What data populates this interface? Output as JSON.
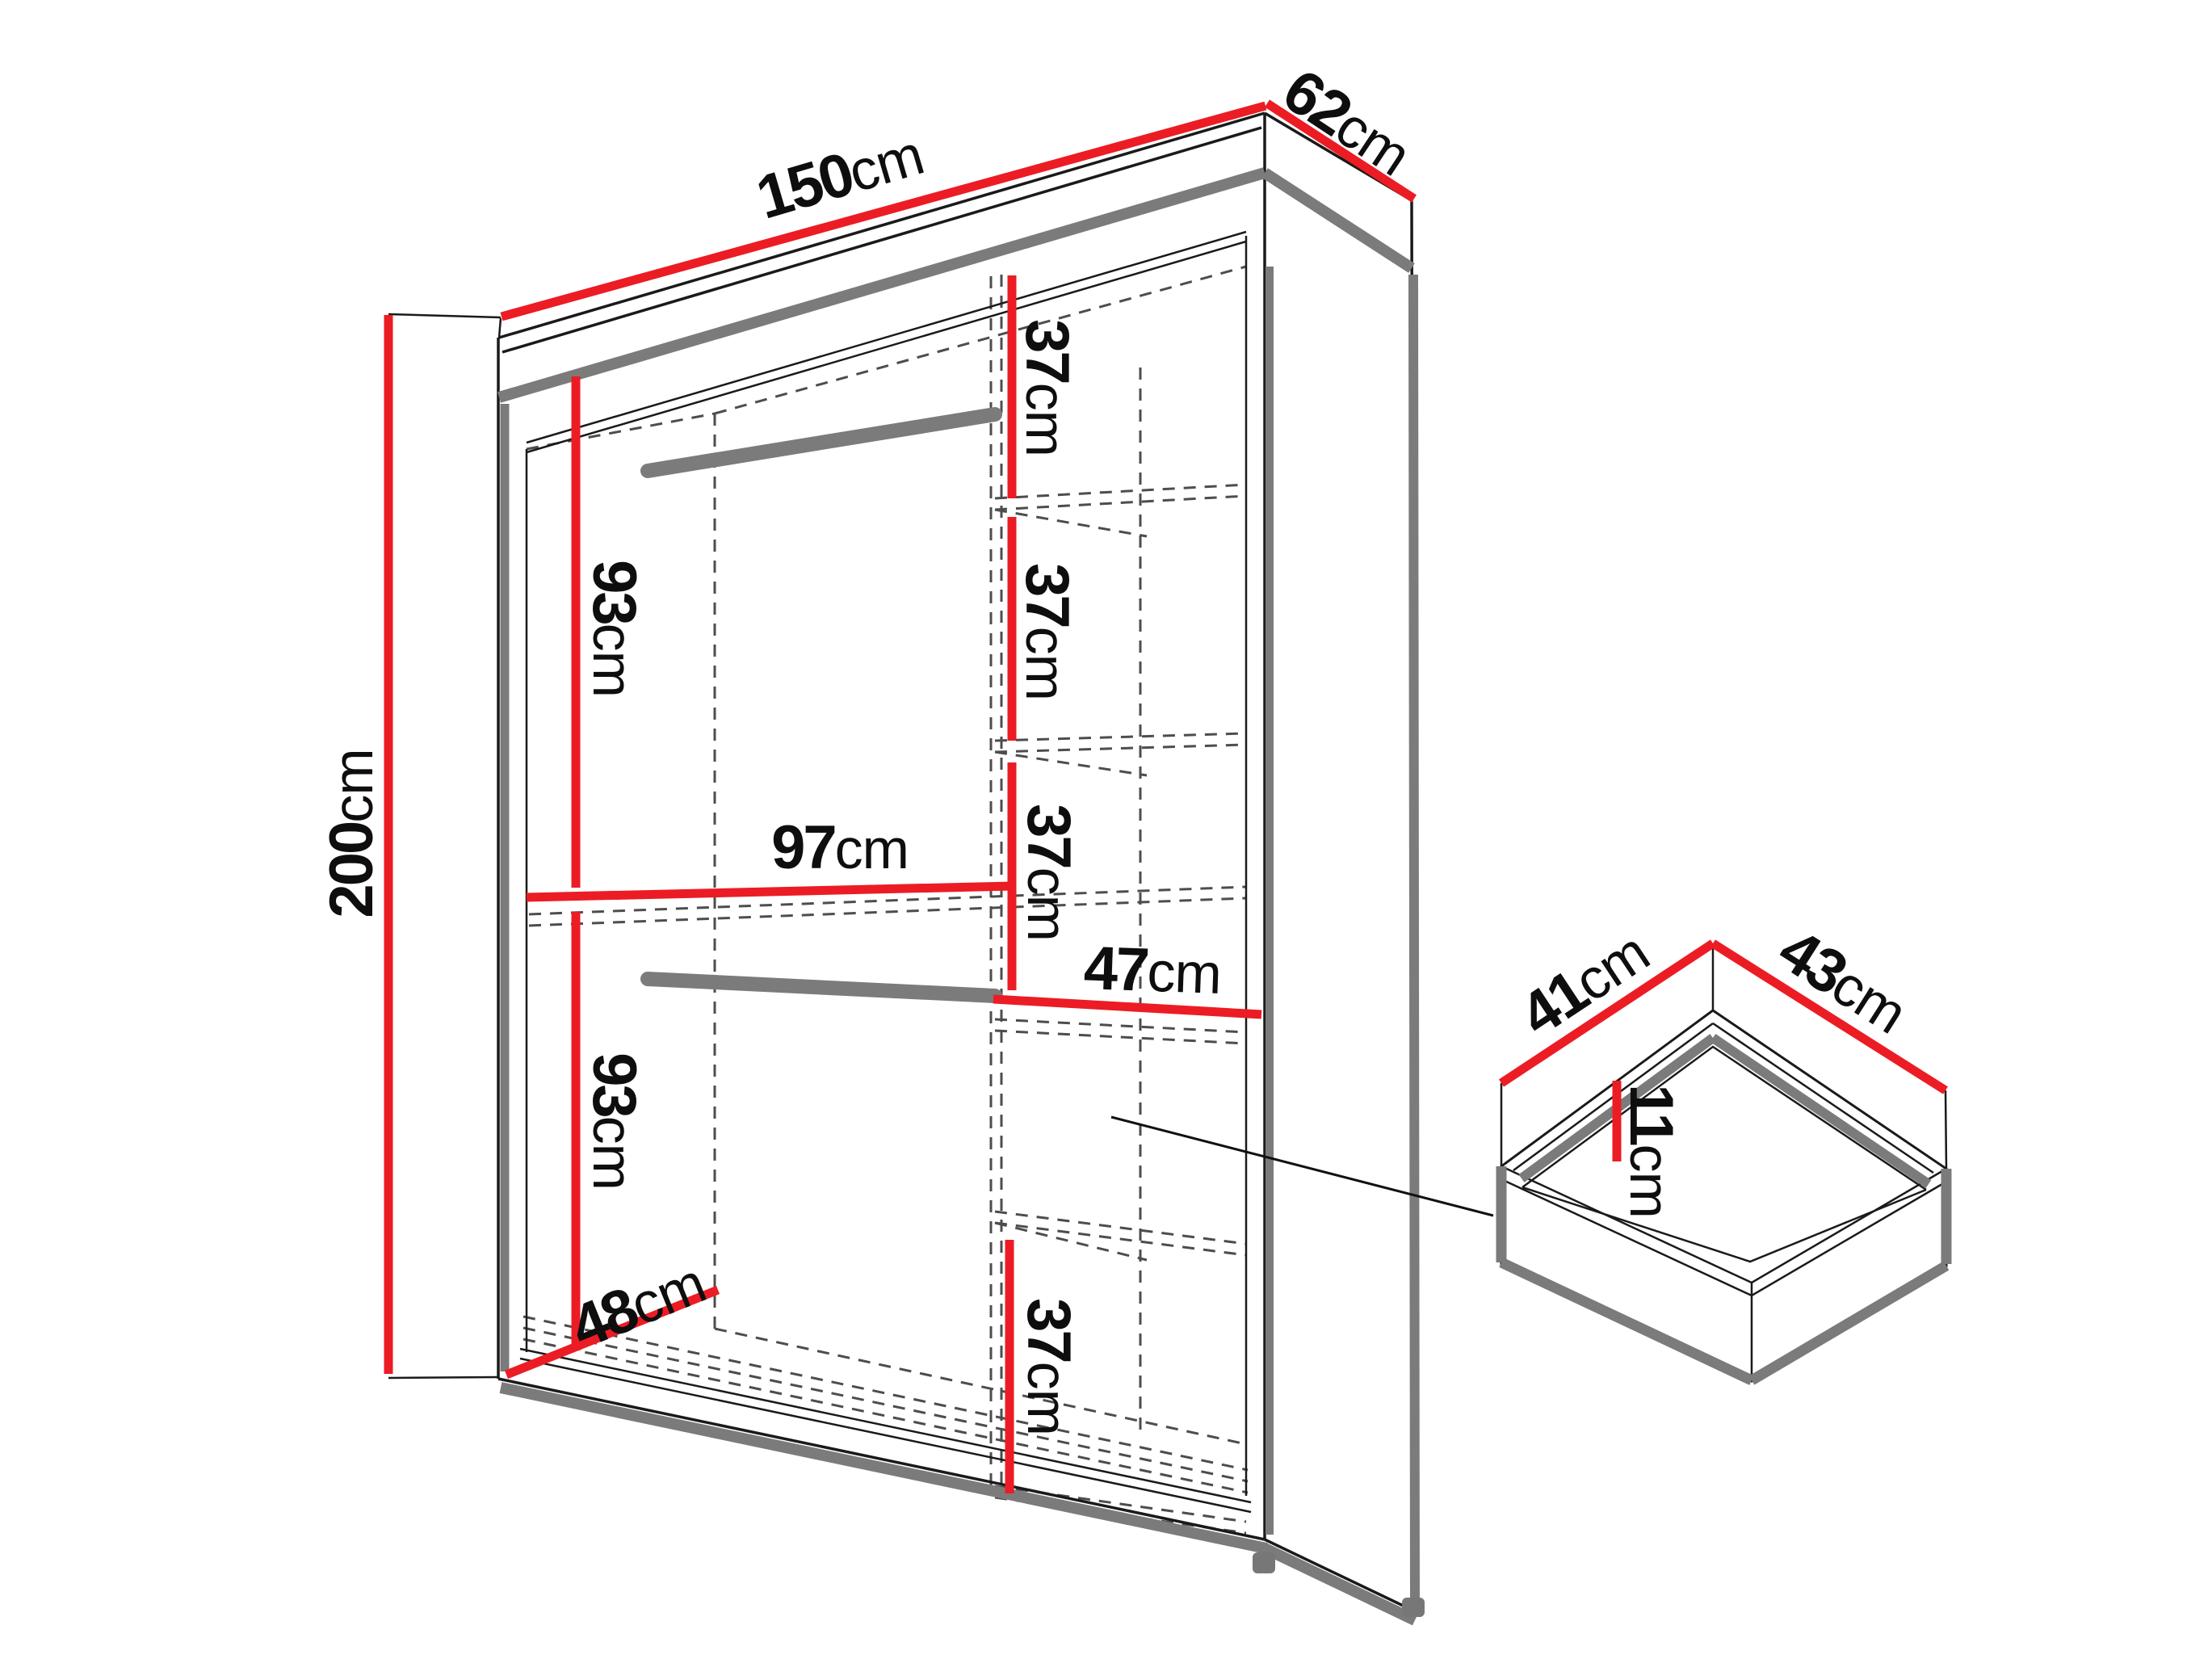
{
  "diagram": {
    "subject": "wardrobe-dimensions-diagram",
    "colors": {
      "dimension_line": "#ec1c24",
      "outline": "#1a1a1a",
      "hidden_edge": "#4d4d4d",
      "metal_gray": "#7b7b7b",
      "text": "#0e0e0e",
      "background": "#ffffff"
    },
    "wardrobe": {
      "overall_width": {
        "value": "150",
        "unit": "cm"
      },
      "overall_depth": {
        "value": "62",
        "unit": "cm"
      },
      "overall_height": {
        "value": "200",
        "unit": "cm"
      },
      "hanging_top": {
        "value": "93",
        "unit": "cm"
      },
      "hanging_bottom": {
        "value": "93",
        "unit": "cm"
      },
      "interior_width": {
        "value": "97",
        "unit": "cm"
      },
      "interior_depth": {
        "value": "48",
        "unit": "cm"
      },
      "shelf_gap_1": {
        "value": "37",
        "unit": "cm"
      },
      "shelf_gap_2": {
        "value": "37",
        "unit": "cm"
      },
      "shelf_gap_3": {
        "value": "37",
        "unit": "cm"
      },
      "shelf_gap_4": {
        "value": "37",
        "unit": "cm"
      },
      "shelf_width": {
        "value": "47",
        "unit": "cm"
      }
    },
    "drawer": {
      "inner_depth": {
        "value": "41",
        "unit": "cm"
      },
      "inner_width": {
        "value": "43",
        "unit": "cm"
      },
      "inner_height": {
        "value": "11",
        "unit": "cm"
      }
    }
  }
}
